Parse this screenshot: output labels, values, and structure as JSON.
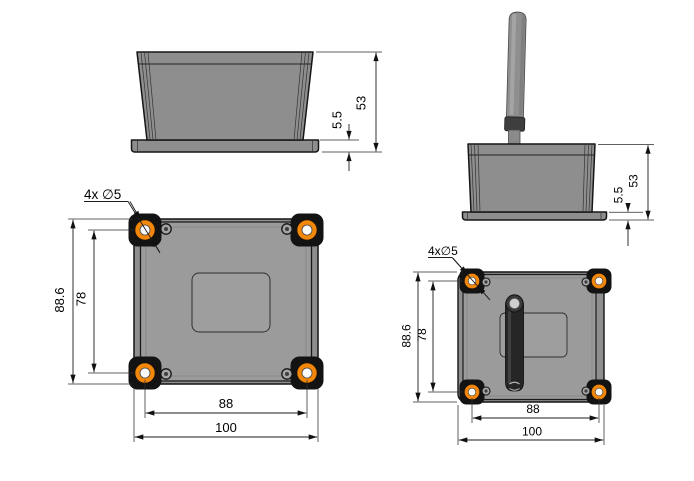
{
  "drawing": {
    "type": "mechanical-dimension-drawing",
    "subject": "electronic enclosure with external antenna, four orthographic/projected views",
    "colors": {
      "background": "#ffffff",
      "outline": "#161616",
      "body_gray": "#8e8e8e",
      "lid_gray": "#9b9b9b",
      "recess_gray": "#9e9e9e",
      "corner_tab": "#131313",
      "hole_ring_orange": "#f2870a",
      "hole_center_white": "#fbfbfb",
      "antenna_dark": "#262626",
      "antenna_tip_gray": "#cecece",
      "dimension_line": "#1c1c1c",
      "text": "#000000"
    },
    "views": {
      "side": {
        "label": "side view",
        "height": "53",
        "flange": "5.5"
      },
      "side_antenna": {
        "label": "side view with antenna",
        "height": "53",
        "flange": "5.5"
      },
      "top": {
        "label": "top view",
        "callout": "4x ∅5",
        "outer_height": "88.6",
        "hole_pitch_v": "78",
        "hole_pitch_h": "88",
        "outer_width": "100"
      },
      "top_antenna": {
        "label": "top view with antenna",
        "callout": "4x∅5",
        "outer_height": "88.6",
        "hole_pitch_v": "78",
        "hole_pitch_h": "88",
        "outer_width": "100"
      }
    }
  }
}
